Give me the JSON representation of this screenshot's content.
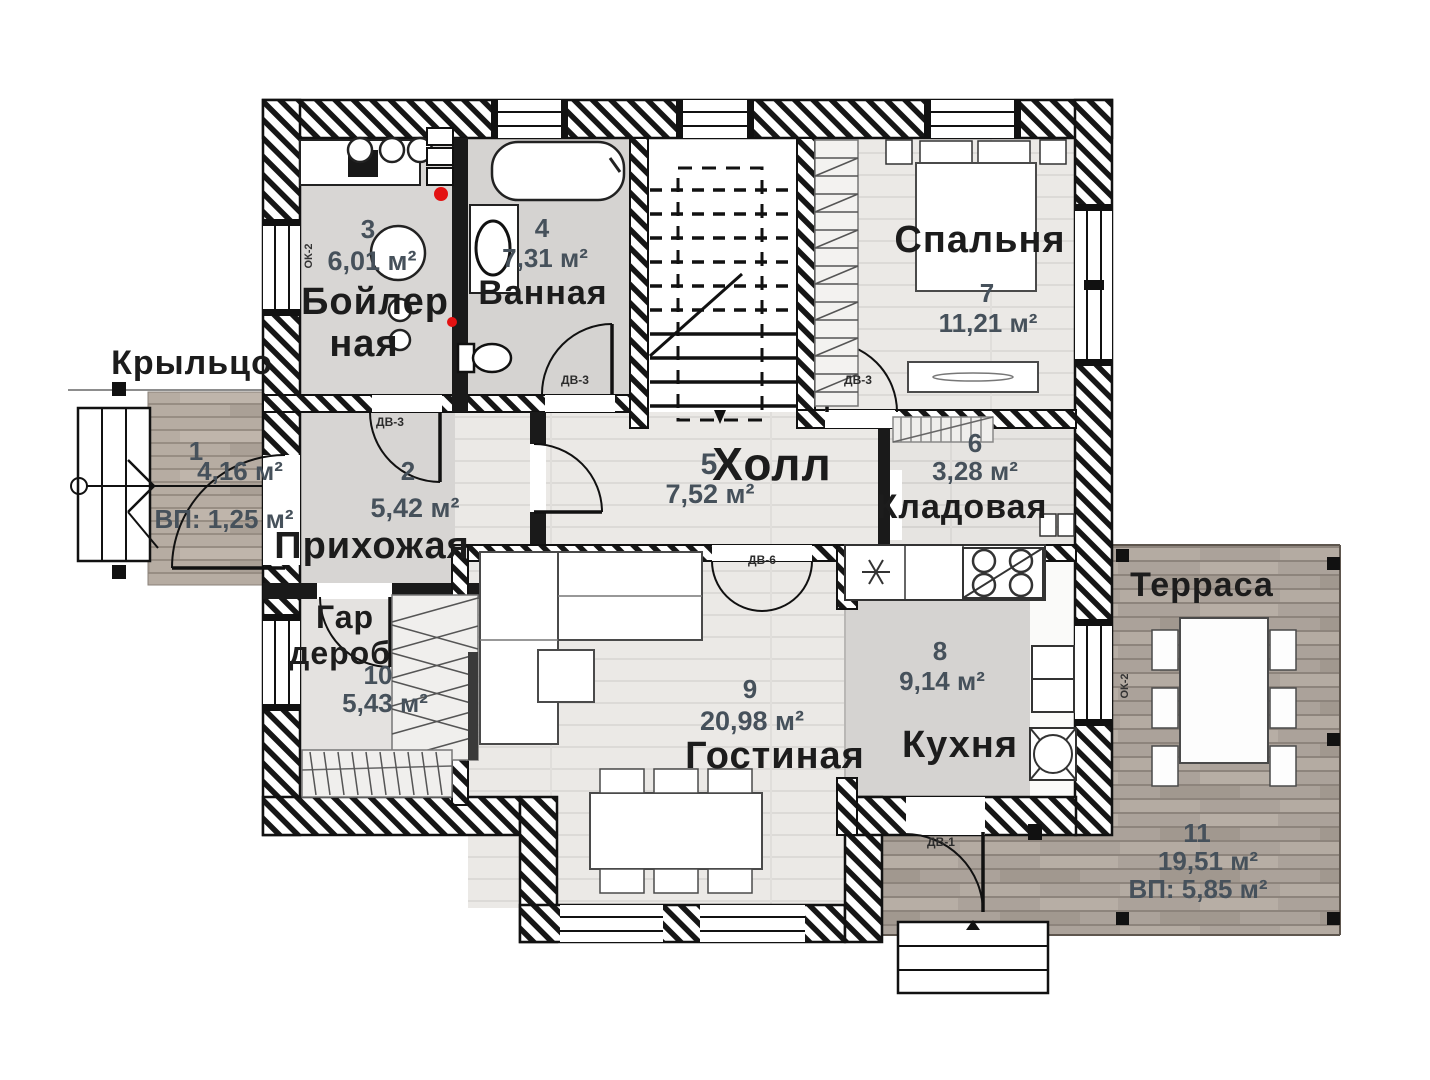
{
  "rooms": {
    "porch": {
      "number": "1",
      "label": "Крыльцо",
      "area": "4,16 м²",
      "vp": "ВП: 1,25 м²"
    },
    "hallway": {
      "number": "2",
      "name": "Прихожая",
      "area": "5,42 м²"
    },
    "boiler": {
      "number": "3",
      "name1": "Бойлер",
      "name2": "ная",
      "area": "6,01 м²"
    },
    "bathroom": {
      "number": "4",
      "name": "Ванная",
      "area": "7,31 м²"
    },
    "hall": {
      "number": "5",
      "name": "Холл",
      "area": "7,52 м²"
    },
    "storage": {
      "number": "6",
      "name": "Кладовая",
      "area": "3,28 м²"
    },
    "bedroom": {
      "number": "7",
      "name": "Спальня",
      "area": "11,21 м²"
    },
    "kitchen": {
      "number": "8",
      "name": "Кухня",
      "area": "9,14 м²"
    },
    "living": {
      "number": "9",
      "name": "Гостиная",
      "area": "20,98 м²"
    },
    "wardrobe": {
      "number": "10",
      "name1": "Гар",
      "name2": "дероб",
      "area": "5,43 м²"
    },
    "terrace": {
      "number": "11",
      "name": "Терраса",
      "area": "19,51 м²",
      "vp": "ВП: 5,85 м²"
    }
  },
  "doors": {
    "dv1": "ДВ-1",
    "dv3": "ДВ-3",
    "dv6": "ДВ-6"
  },
  "windows": {
    "ok2": "ОК-2"
  },
  "colors": {
    "wall": "#141414",
    "marker_red": "#e31212",
    "number_text": "#46515b",
    "name_text": "#1c1c1c",
    "terrace_wood": "#aba29a",
    "porch_wood": "#b6aca2",
    "floor_light": "#ebe9e6",
    "floor_gray": "#d7d5d3"
  }
}
